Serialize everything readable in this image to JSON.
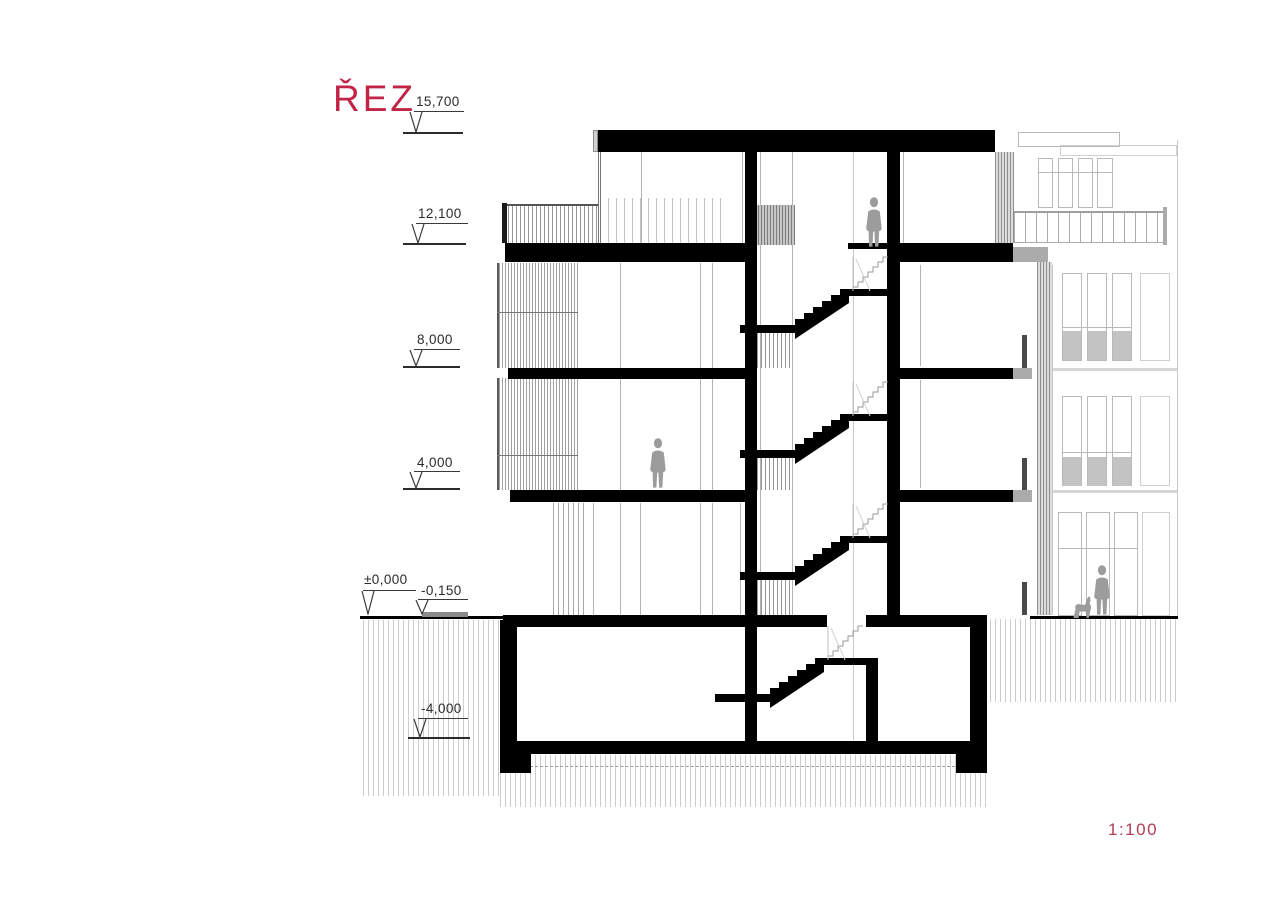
{
  "title": "ŘEZ",
  "scale": {
    "label": "1:100"
  },
  "levels": [
    {
      "label": "15,700"
    },
    {
      "label": "12,100"
    },
    {
      "label": "8,000"
    },
    {
      "label": "4,000"
    },
    {
      "label": "±0,000"
    },
    {
      "label": "-0,150"
    },
    {
      "label": "-4,000"
    }
  ],
  "colors": {
    "accent_red": "#c22447",
    "cut_black": "#000000",
    "background_gray": "#b9b9b9",
    "figure_gray": "#9c9c9c",
    "earth_hatch": "#cdcdcd"
  },
  "figures": [
    {
      "name": "person-on-stair-landing"
    },
    {
      "name": "person-on-second-floor"
    },
    {
      "name": "person-with-dog-on-street"
    }
  ]
}
